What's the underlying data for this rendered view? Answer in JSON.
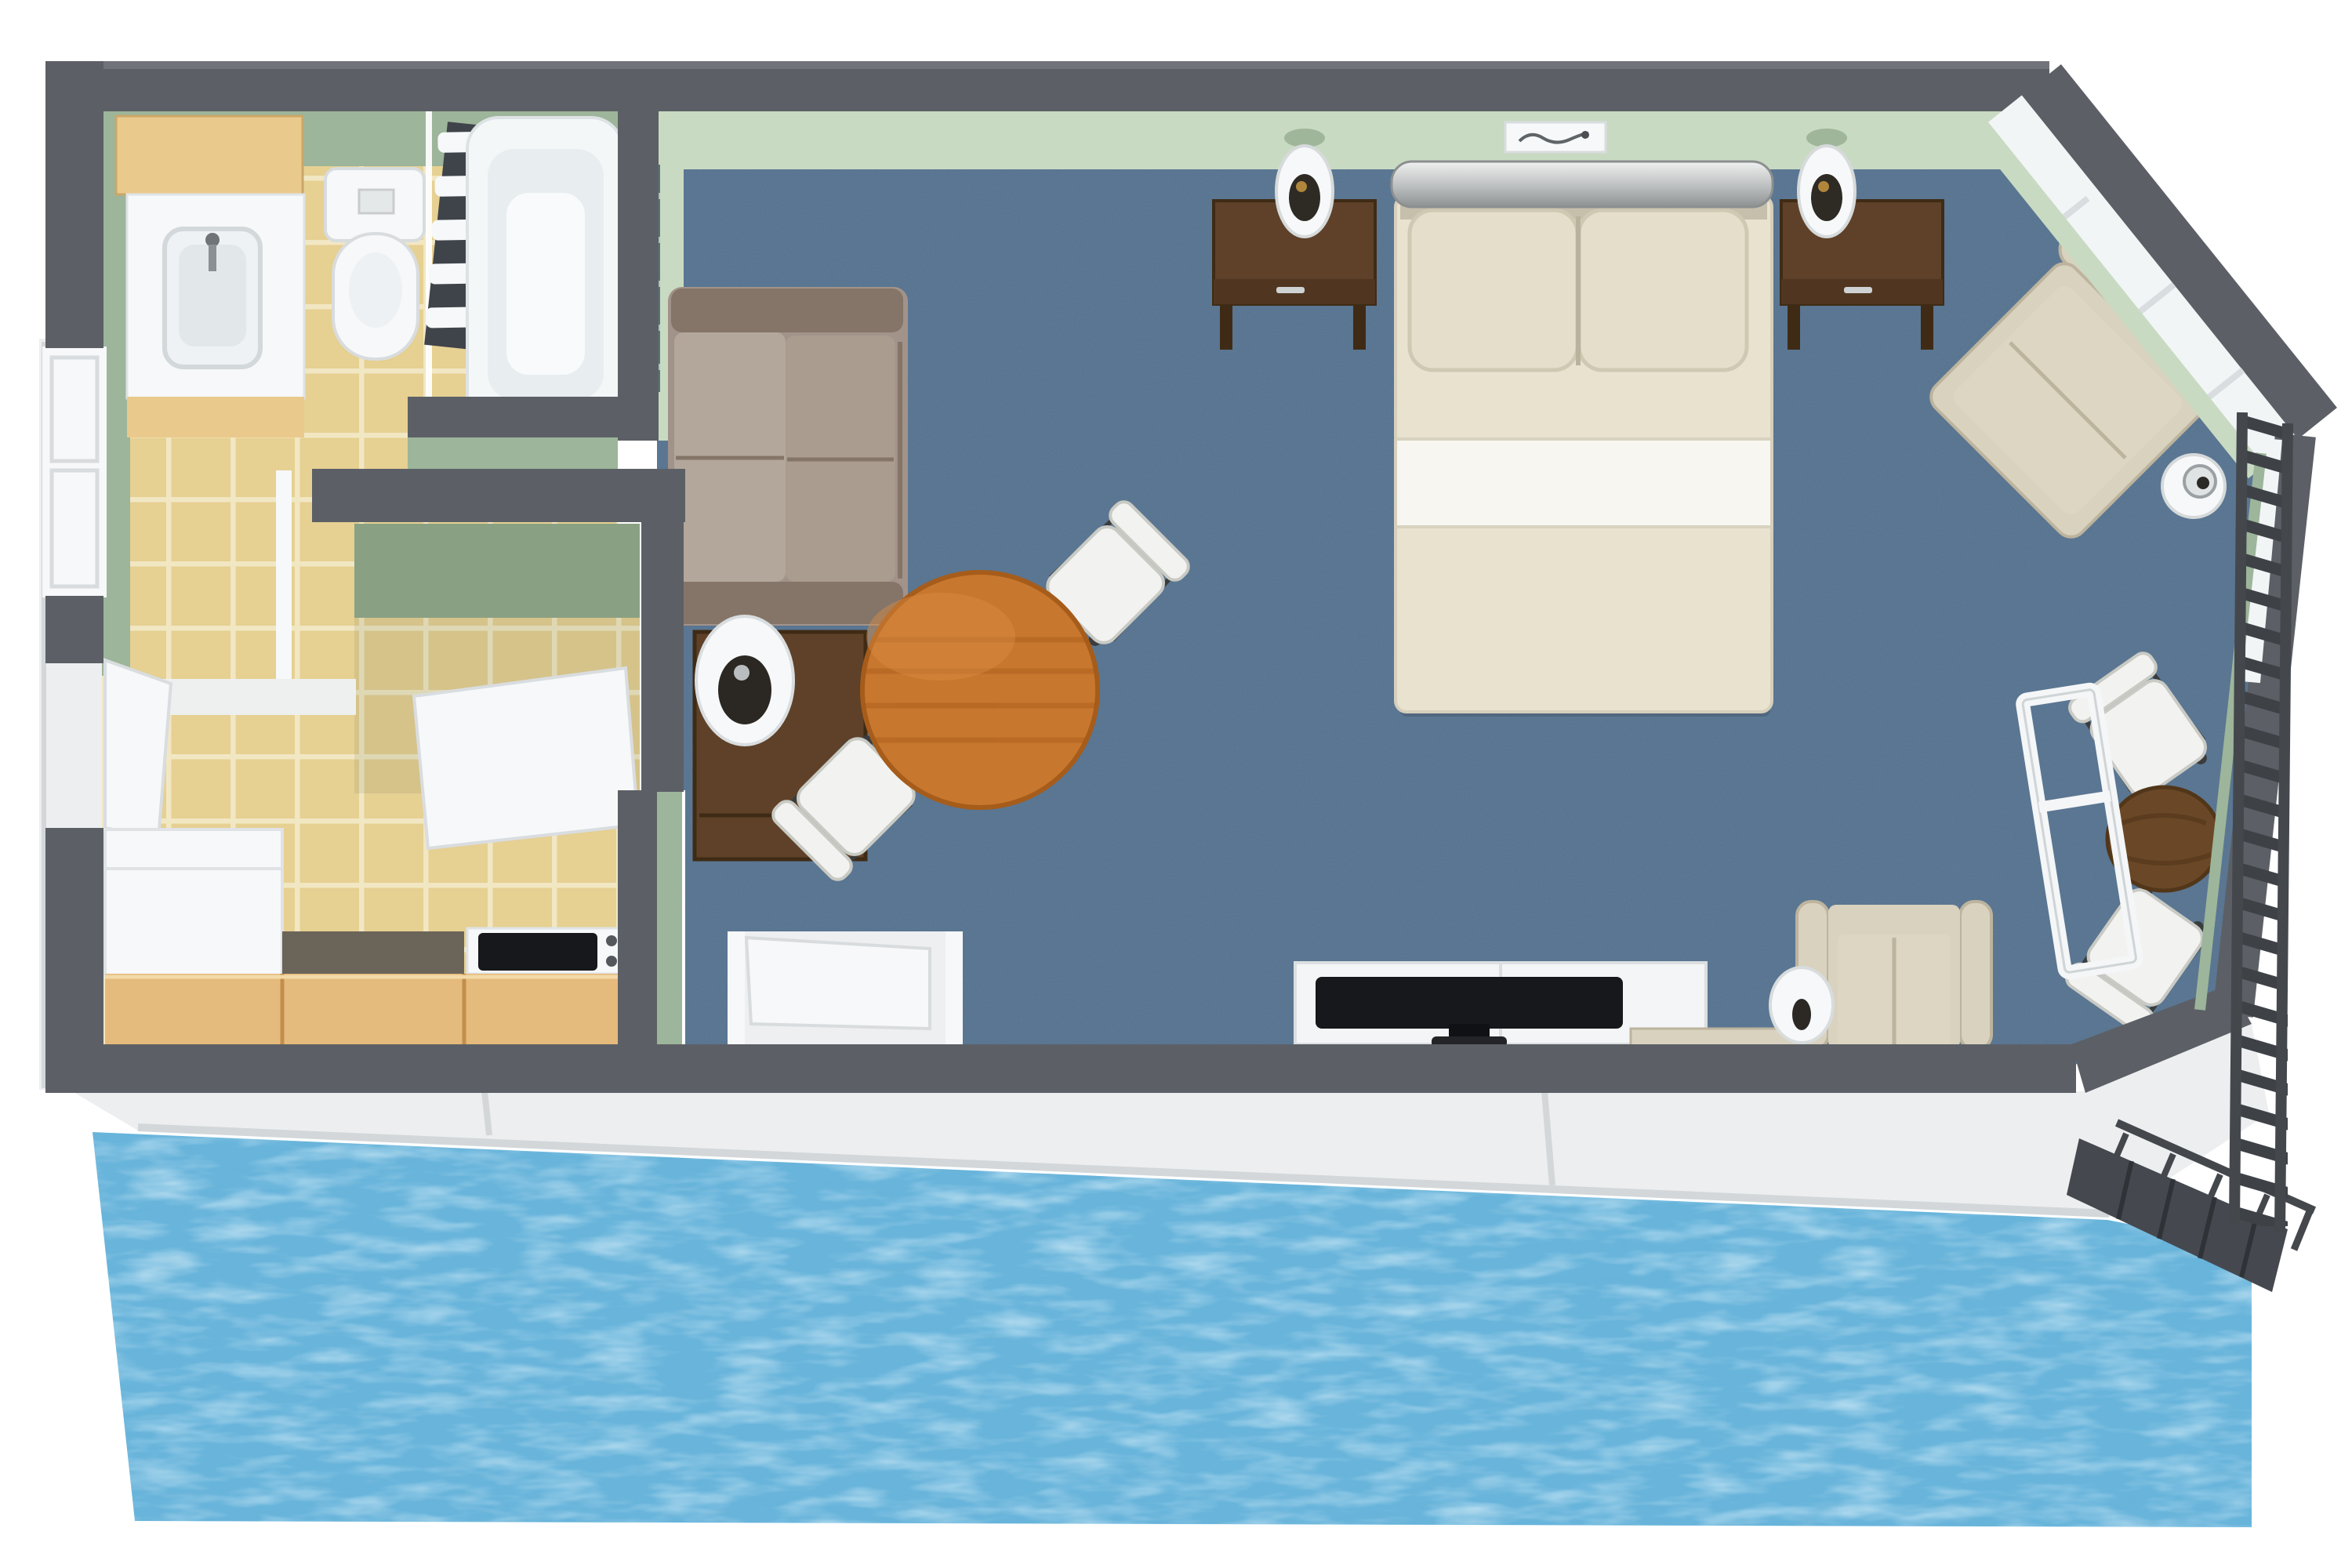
{
  "scene": {
    "kind": "3d-floorplan-top-view",
    "description": "overwater hotel suite floor plan with deck and water below",
    "rooms": [
      {
        "name": "bathroom",
        "items": [
          "vanity-sink",
          "toilet",
          "bathtub",
          "towel-rack",
          "glass-screen"
        ]
      },
      {
        "name": "hall-closet",
        "items": [
          "open-closet-door"
        ]
      },
      {
        "name": "kitchenette",
        "items": [
          "fridge-cabinet",
          "counter",
          "stove-cooktop",
          "entry-door",
          "window"
        ]
      },
      {
        "name": "bedroom-living",
        "items": [
          "sofa",
          "side-table-lamp",
          "round-dining-table",
          "two-white-chairs",
          "double-bed",
          "two-nightstands",
          "two-bedside-lamps",
          "wall-picture",
          "tv-console",
          "flat-tv",
          "highback-chair",
          "vase-lamp",
          "corner-armchair",
          "floor-ball-lamp",
          "nook-table",
          "two-nook-chairs",
          "open-window"
        ]
      },
      {
        "name": "exterior",
        "items": [
          "deck",
          "water",
          "gangway-walkway",
          "railing"
        ]
      }
    ]
  },
  "colors": {
    "wall": "#5c6066",
    "walledge": "#70747a",
    "greenface": "#c9dac2",
    "greenside": "#9db59a",
    "greendark": "#8aa083",
    "tile": "#e6d092",
    "grout": "#f2e7c3",
    "carpet": "#5d7893",
    "deck": "#eceeef",
    "deckedge": "#d3d7d9",
    "water": "#68b4db",
    "wood": "#e5ba7d",
    "wooddark": "#c28e4b",
    "vanity": "#e9c98c",
    "sofa": "#a2938a",
    "sofadark": "#857569",
    "sofalight": "#b3a79b",
    "bed": "#e9e2cf",
    "bedsheet": "#f7f6f0",
    "pillow": "#e5deca",
    "darkwood": "#5e4128",
    "darkwood2": "#3f2b15",
    "tablewood": "#c8772e",
    "tablewooddark": "#a65c1a",
    "chair": "#f2f3f1",
    "chairedge": "#d7d8d3",
    "beige": "#d9d2bf",
    "beigedark": "#bdb49e",
    "cushion": "#ddd6c3",
    "tv": "#17181b",
    "console": "#f3f5f6",
    "teal": "#52767c",
    "teallight": "#a8c4c6",
    "gangway": "#45494f",
    "nook": "#6a4827",
    "white": "#f6f8f9",
    "fixedge": "#d8dcde",
    "speckle": "#6b6459",
    "recess": "#edeff0"
  }
}
